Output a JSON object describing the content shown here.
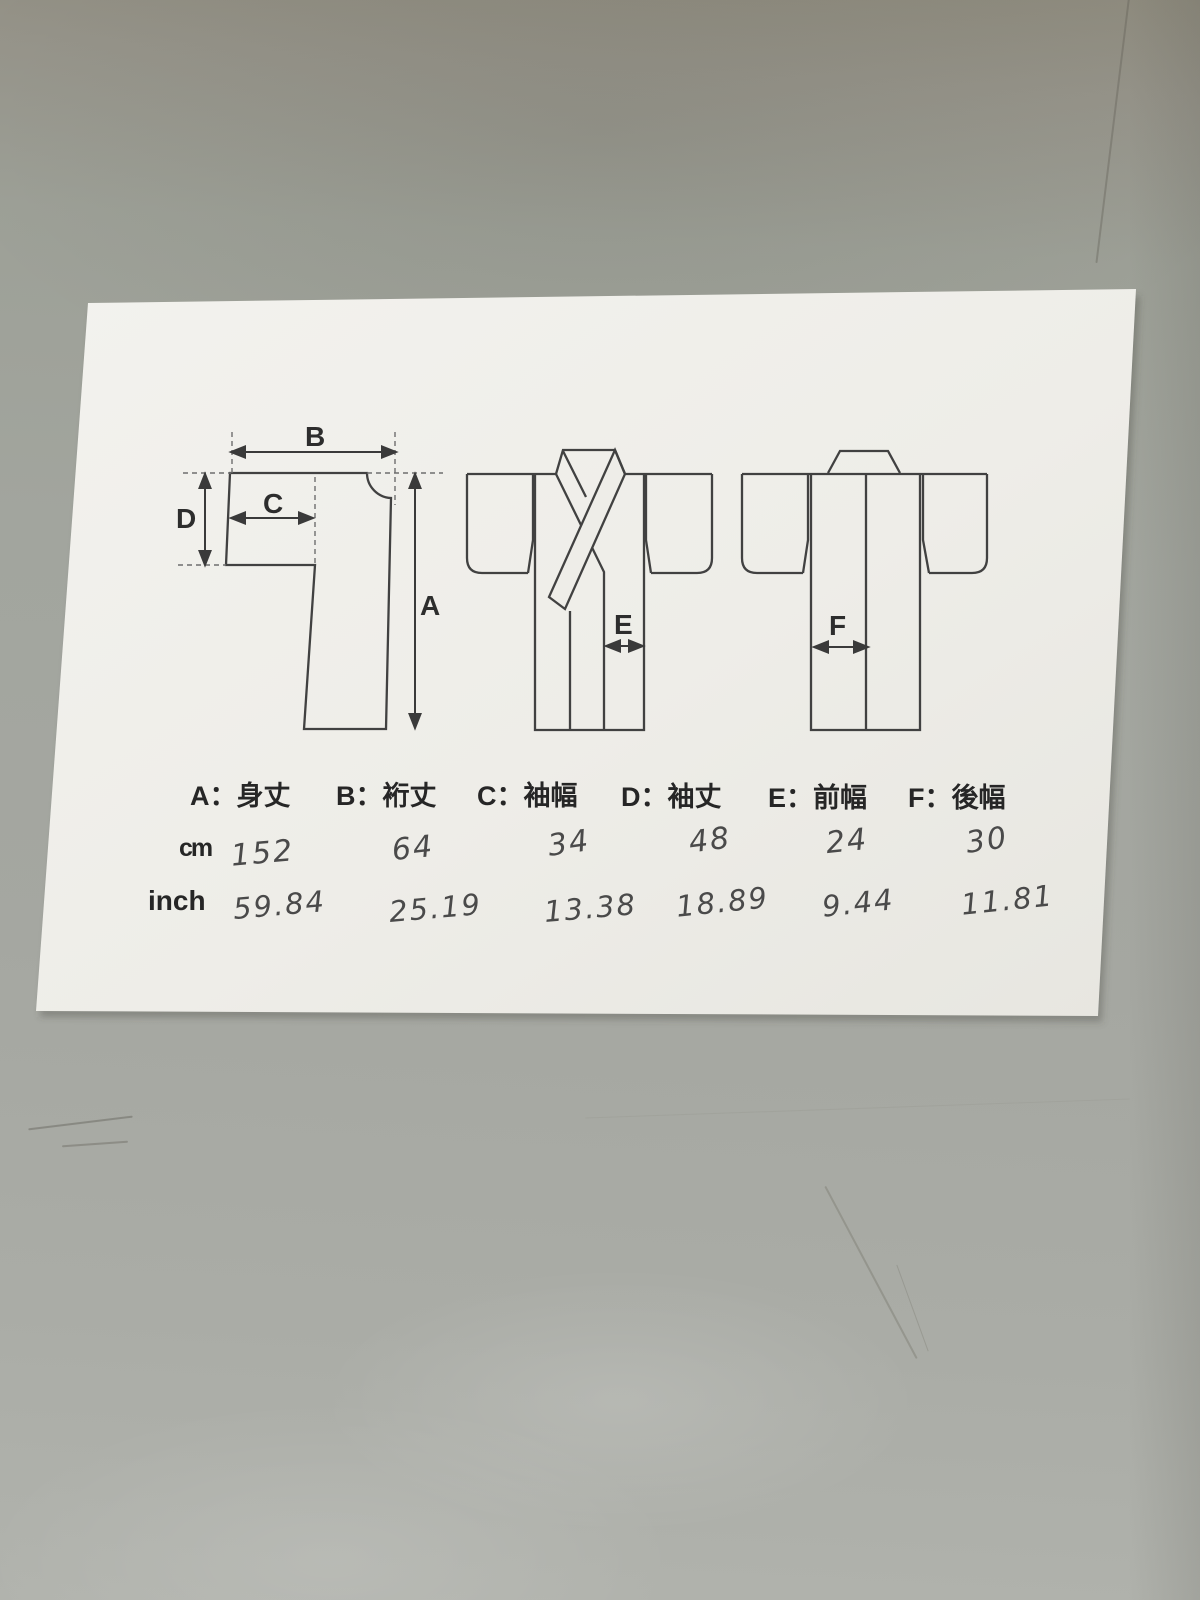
{
  "measurement_table": {
    "headers": [
      "A：身丈",
      "B：裄丈",
      "C：袖幅",
      "D：袖丈",
      "E：前幅",
      "F：後幅"
    ],
    "unit_cm_label": "cm",
    "unit_inch_label": "inch",
    "cm_values": [
      "152",
      "64",
      "34",
      "48",
      "24",
      "30"
    ],
    "inch_values": [
      "59.84",
      "25.19",
      "13.38",
      "18.89",
      "9.44",
      "11.81"
    ]
  },
  "diagram_labels": {
    "a": "A",
    "b": "B",
    "c": "C",
    "d": "D",
    "e": "E",
    "f": "F"
  },
  "colors": {
    "paper": "#efeee9",
    "line": "#414141",
    "background": "#a2a49e",
    "handwriting": "#4a4a4a"
  }
}
